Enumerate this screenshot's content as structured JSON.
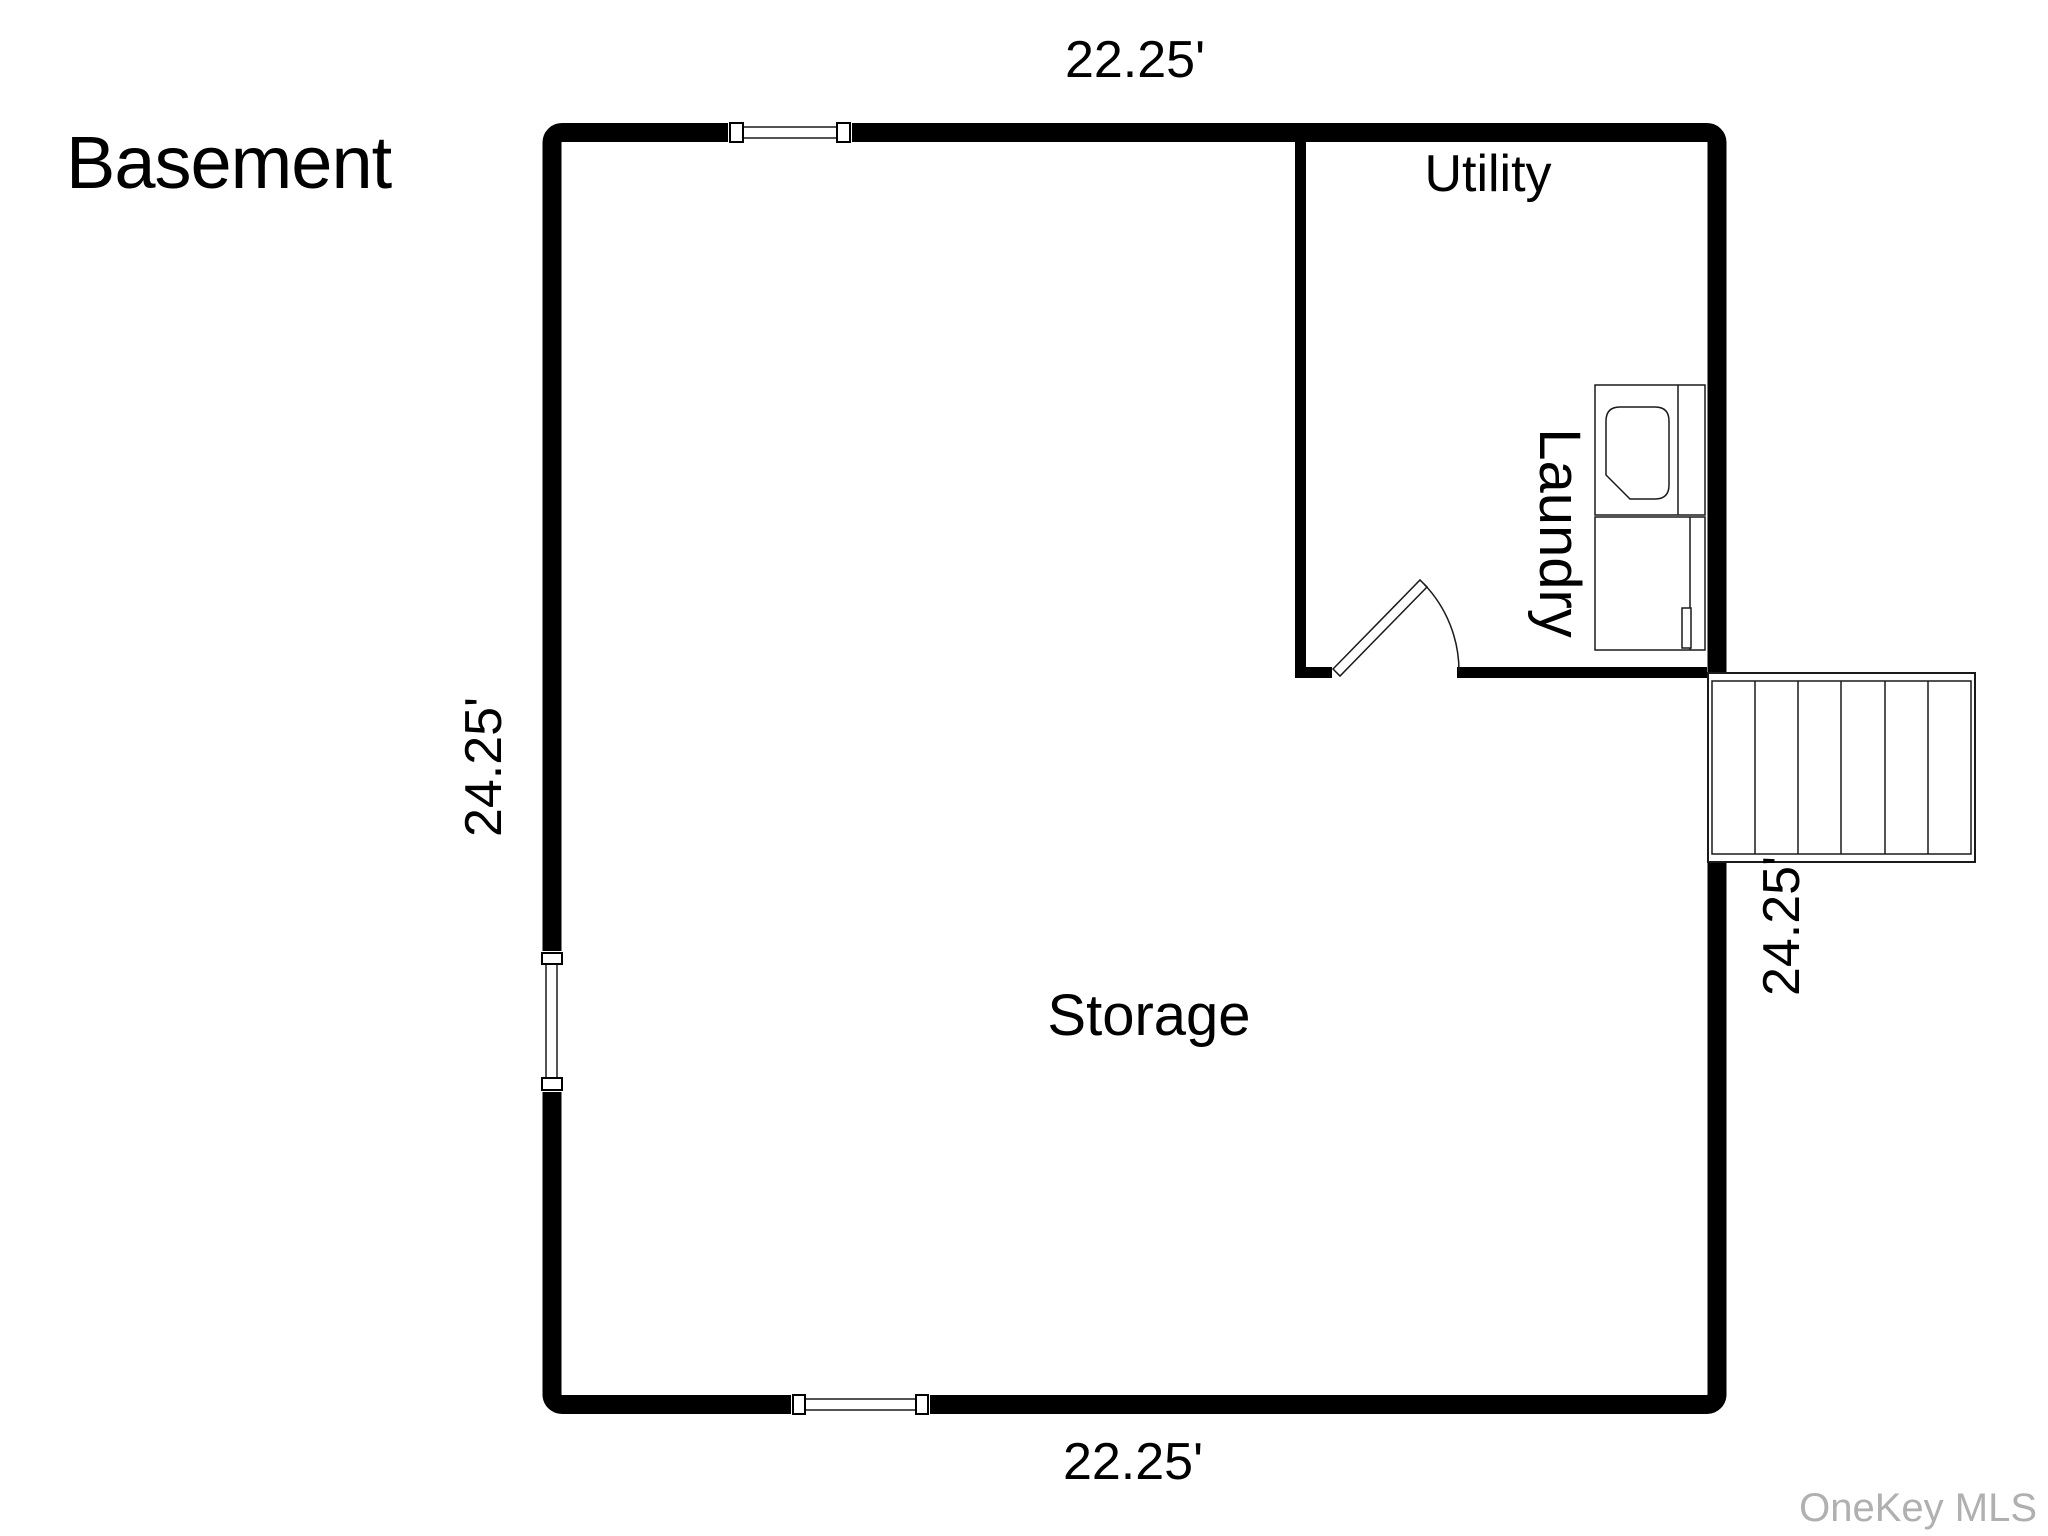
{
  "floor_plan": {
    "title": "Basement",
    "rooms": {
      "utility": "Utility",
      "laundry": "Laundry",
      "storage": "Storage"
    },
    "dimensions": {
      "top": "22.25'",
      "bottom": "22.25'",
      "left": "24.25'",
      "right": "24.25'"
    },
    "fixtures": {
      "washer_icon": "washer",
      "dryer_icon": "dryer",
      "door_icon": "door-swing",
      "stairs_icon": "staircase",
      "window_icon": "window",
      "stair_tread_count": 6
    },
    "watermark": "OneKey MLS",
    "colors": {
      "wall": "#000000",
      "background": "#ffffff",
      "thin_line": "#1a1a1a",
      "watermark": "#b0b0b0"
    }
  }
}
